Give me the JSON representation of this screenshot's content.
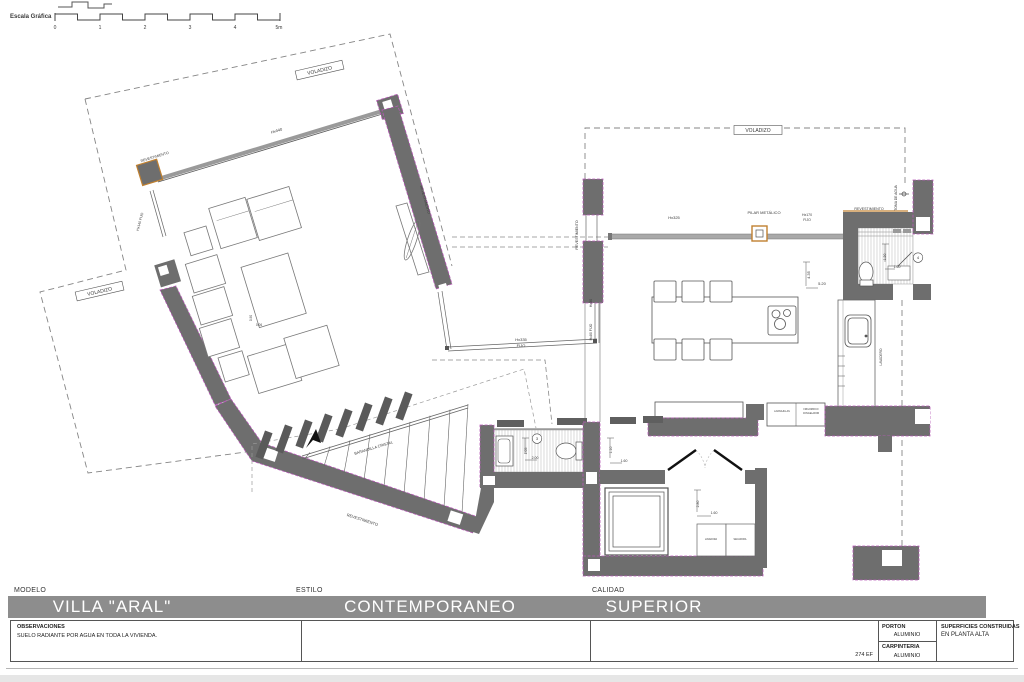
{
  "scale_bar": {
    "label": "Escala Gráfica",
    "ticks": [
      "0",
      "1",
      "2",
      "3",
      "4",
      "5m"
    ]
  },
  "colors": {
    "wall": "#6e6e6e",
    "accent_orange": "#c08030",
    "accent_magenta": "#b85ab8",
    "title_bar": "#8d8d8d"
  },
  "plan": {
    "labels": [
      {
        "t": "Escala Gráfica",
        "x": 10,
        "y": 18,
        "s": 6,
        "a": "start",
        "b": 1
      },
      {
        "t": "0",
        "x": 55,
        "y": 29,
        "s": 5
      },
      {
        "t": "1",
        "x": 100,
        "y": 29,
        "s": 5
      },
      {
        "t": "2",
        "x": 145,
        "y": 29,
        "s": 5
      },
      {
        "t": "3",
        "x": 190,
        "y": 29,
        "s": 5
      },
      {
        "t": "4",
        "x": 235,
        "y": 29,
        "s": 5
      },
      {
        "t": "5m",
        "x": 279,
        "y": 29,
        "s": 5
      },
      {
        "t": "VOLADIZO",
        "x": 320,
        "y": 72,
        "r": -13,
        "s": 5,
        "box": [
          48,
          9
        ]
      },
      {
        "t": "VOLADIZO",
        "x": 100,
        "y": 293,
        "r": -13,
        "s": 5,
        "box": [
          48,
          9
        ]
      },
      {
        "t": "VOLADIZO",
        "x": 758,
        "y": 132,
        "s": 5,
        "box": [
          48,
          9
        ]
      },
      {
        "t": "Hx440",
        "x": 277,
        "y": 132,
        "r": -17,
        "s": 4
      },
      {
        "t": "REVESTIMIENTO",
        "x": 155,
        "y": 158,
        "r": -17,
        "s": 3.6
      },
      {
        "t": "Hx140 FIJO",
        "x": 141,
        "y": 222,
        "r": -75,
        "s": 3.5
      },
      {
        "t": "REVESTIMIENTO",
        "x": 424,
        "y": 200,
        "r": 74,
        "s": 3.6
      },
      {
        "t": "0.90",
        "x": 252,
        "y": 318,
        "r": -90,
        "s": 3.2
      },
      {
        "t": "0.06",
        "x": 259,
        "y": 326,
        "s": 3.2
      },
      {
        "t": "Hx335",
        "x": 521,
        "y": 341,
        "s": 4
      },
      {
        "t": "FIJO",
        "x": 521,
        "y": 347,
        "s": 4
      },
      {
        "t": "Hx80",
        "x": 592,
        "y": 303,
        "r": -90,
        "s": 3.5
      },
      {
        "t": "Hx80 FIJO",
        "x": 592,
        "y": 332,
        "r": -90,
        "s": 3.5
      },
      {
        "t": "BARANDILLA CRISTAL",
        "x": 374,
        "y": 449,
        "r": -17,
        "s": 3.8
      },
      {
        "t": "REVESTIMIENTO",
        "x": 362,
        "y": 521,
        "r": 18,
        "s": 4
      },
      {
        "t": "REVESTIMIENTO",
        "x": 578,
        "y": 235,
        "r": -90,
        "s": 3.6
      },
      {
        "t": "Hx325",
        "x": 674,
        "y": 219,
        "s": 4
      },
      {
        "t": "PILAR METÁLICO",
        "x": 764,
        "y": 214,
        "s": 4
      },
      {
        "t": "Hx170",
        "x": 807,
        "y": 216,
        "s": 3.5
      },
      {
        "t": "FIJO",
        "x": 807,
        "y": 221,
        "s": 3.5
      },
      {
        "t": "REVESTIMIENTO",
        "x": 869,
        "y": 210,
        "s": 3.6
      },
      {
        "t": "TOMA DE AGUA",
        "x": 897,
        "y": 198,
        "r": -90,
        "s": 3.4
      },
      {
        "t": "4.35",
        "x": 810,
        "y": 275,
        "r": -90,
        "s": 4
      },
      {
        "t": "5.20",
        "x": 822,
        "y": 285,
        "s": 4
      },
      {
        "t": "1.20",
        "x": 886,
        "y": 257,
        "r": -90,
        "s": 3.5
      },
      {
        "t": "1.60",
        "x": 897,
        "y": 268,
        "s": 3.5
      },
      {
        "t": "4",
        "x": 918,
        "y": 259,
        "s": 4,
        "circle": 1
      },
      {
        "t": "LAVADERO",
        "x": 882,
        "y": 357,
        "r": -90,
        "s": 3.2
      },
      {
        "t": "LAVAVAJILLAS",
        "x": 782,
        "y": 412,
        "s": 2.3
      },
      {
        "t": "FRIGORIFICO",
        "x": 811,
        "y": 410,
        "s": 2.3
      },
      {
        "t": "CONGELADOR",
        "x": 811,
        "y": 414,
        "s": 2.3
      },
      {
        "t": "3",
        "x": 537,
        "y": 440,
        "s": 4,
        "circle": 1
      },
      {
        "t": "1.05",
        "x": 527,
        "y": 451,
        "r": -90,
        "s": 3.5
      },
      {
        "t": "2.00",
        "x": 535,
        "y": 459,
        "s": 3.5
      },
      {
        "t": "1.10",
        "x": 612,
        "y": 450,
        "r": -90,
        "s": 3.5
      },
      {
        "t": "1.60",
        "x": 624,
        "y": 462,
        "s": 3.5
      },
      {
        "t": "2.80",
        "x": 699,
        "y": 504,
        "r": -90,
        "s": 3.5
      },
      {
        "t": "1.60",
        "x": 714,
        "y": 514,
        "s": 3.5
      },
      {
        "t": "LAVADORA",
        "x": 711,
        "y": 540,
        "s": 2.3
      },
      {
        "t": "SECADORA",
        "x": 740,
        "y": 540,
        "s": 2.3
      }
    ]
  },
  "title_block": {
    "modelo_label": "MODELO",
    "modelo": "VILLA \"ARAL\"",
    "estilo_label": "ESTILO",
    "estilo": "CONTEMPORANEO",
    "calidad_label": "CALIDAD",
    "calidad": "SUPERIOR",
    "observaciones_label": "OBSERVACIONES",
    "observaciones": "SUELO RADIANTE POR AGUA EN TODA LA VIVIENDA.",
    "ref": "274 EF",
    "porton_label": "PORTON",
    "porton": "ALUMINIO",
    "carpinteria_label": "CARPINTERIA",
    "carpinteria": "ALUMINIO",
    "superficies_label": "SUPERFICIES CONSTRUIDAS",
    "superficies": "EN PLANTA ALTA"
  }
}
